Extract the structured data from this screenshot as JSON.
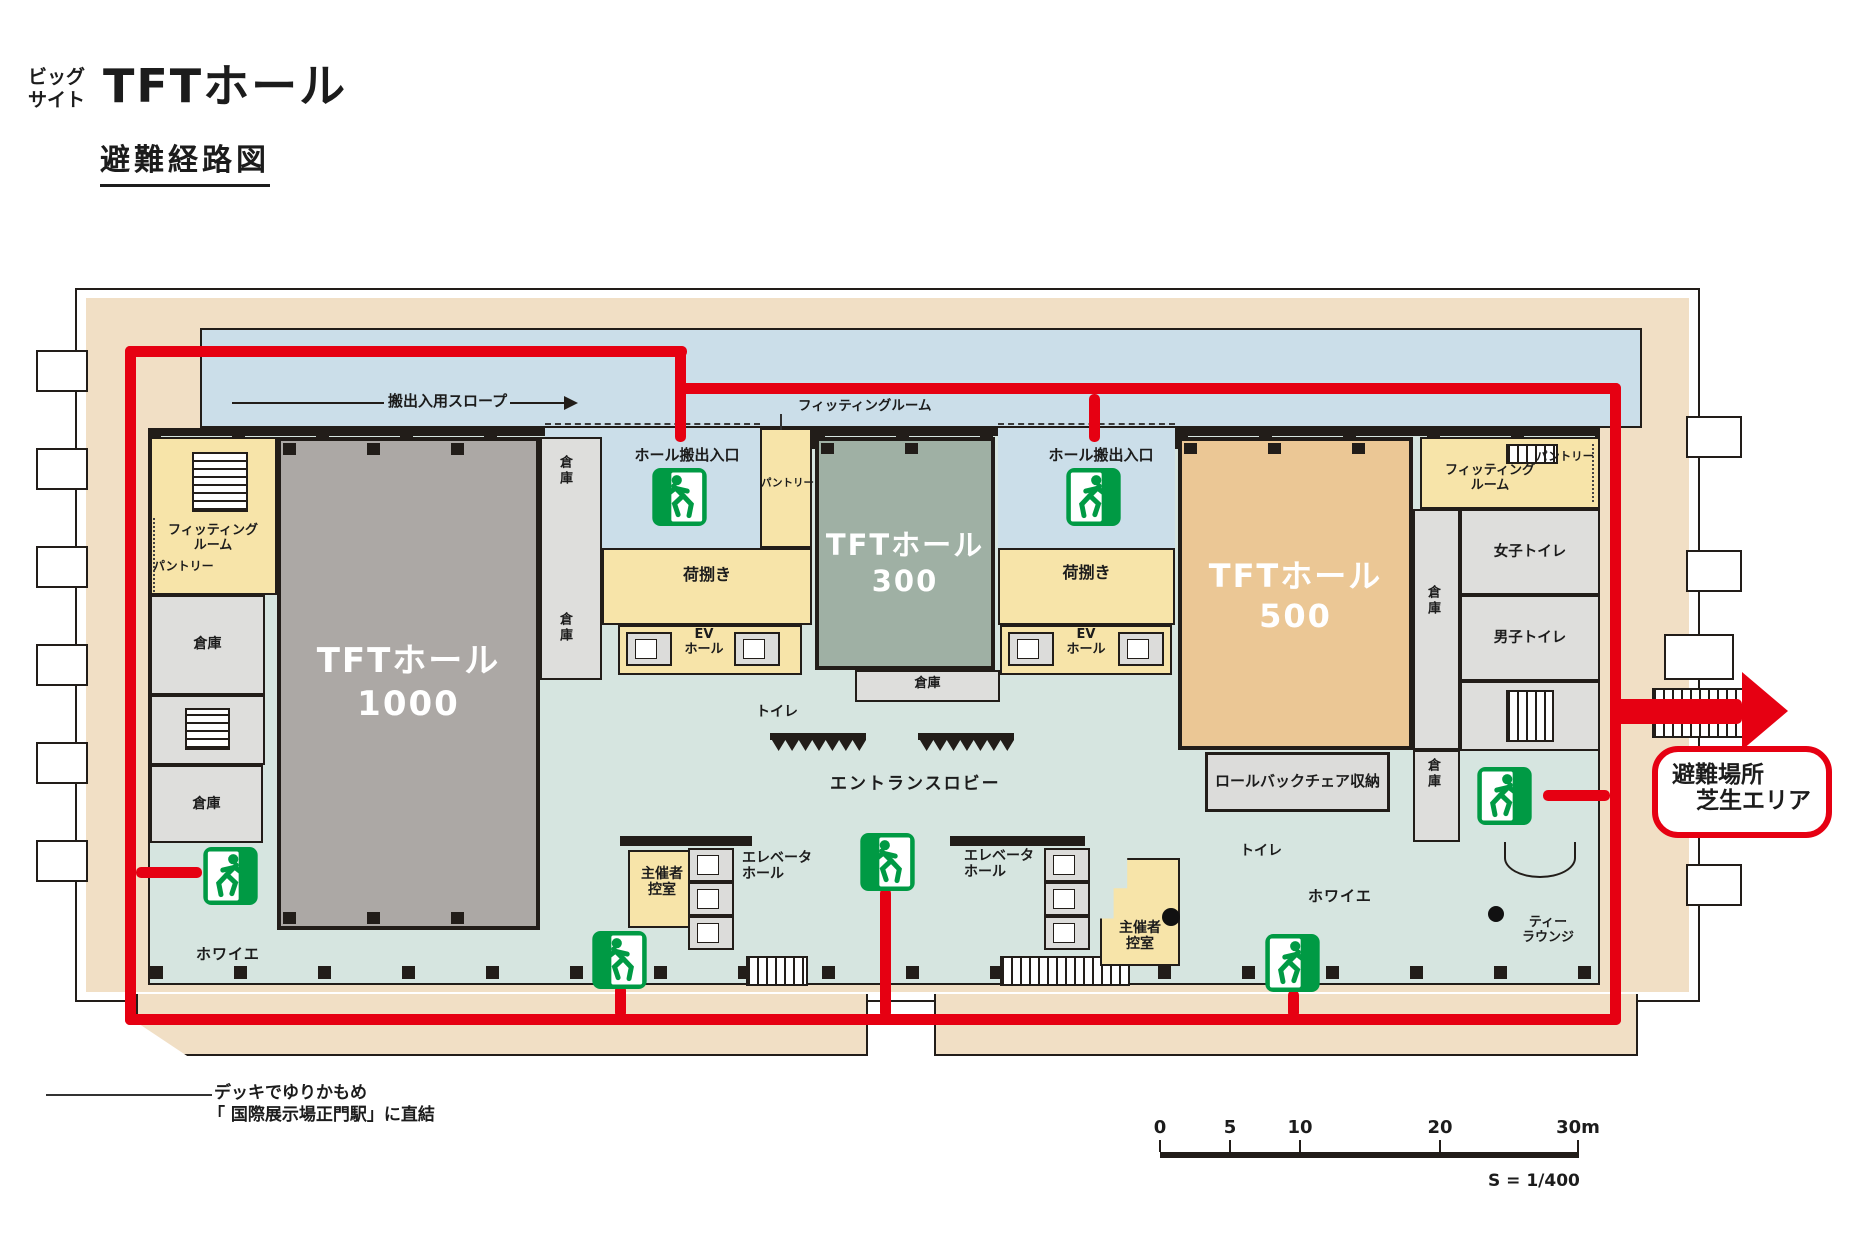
{
  "header": {
    "site_small": [
      "ビッグ",
      "サイト"
    ],
    "title": "TFTホール",
    "subtitle": "避難経路図"
  },
  "plan": {
    "slope_label": "搬出入用スロープ",
    "hall_exit_label": "ホール搬出入口",
    "halls": {
      "h1000": {
        "name": "TFTホール",
        "number": "1000"
      },
      "h300": {
        "name": "TFTホール",
        "number": "300"
      },
      "h500": {
        "name": "TFTホール",
        "number": "500"
      }
    },
    "rooms": {
      "fitting": [
        "フィッティング",
        "ルーム"
      ],
      "fitting_joined": "フィッティングルーム",
      "pantry": "パントリー",
      "storage": "倉庫",
      "cargo": "荷捌き",
      "ev_hall": [
        "EV",
        "ホール"
      ],
      "toilet": "トイレ",
      "entrance_lobby": "エントランスロビー",
      "organizer": [
        "主催者",
        "控室"
      ],
      "elevator_hall": [
        "エレベータ",
        "ホール"
      ],
      "foyer": "ホワイエ",
      "rollback_storage": "ロールバックチェア収納",
      "womens_toilet": "女子トイレ",
      "mens_toilet": "男子トイレ",
      "tea_lounge": [
        "ティー",
        "ラウンジ"
      ]
    },
    "evacuation_site": [
      "避難場所",
      "芝生エリア"
    ],
    "deck_note": [
      "デッキでゆりかもめ",
      "「 国際展示場正門駅」に直結"
    ],
    "scale": {
      "ticks": [
        "0",
        "5",
        "10",
        "20"
      ],
      "end": "30m",
      "ratio": "S = 1/400"
    }
  },
  "colors": {
    "route_red": "#E60012",
    "exit_green": "#009A44",
    "hall_gray": "#ACA8A5",
    "hall_green": "#9FB0A4",
    "hall_tan": "#EBC795",
    "service_yellow": "#F7E4A9",
    "slope_blue": "#CBDEE9",
    "floor_teal": "#D6E5E0",
    "band_beige": "#F1DFC5",
    "room_gray": "#DEDEDC",
    "wall_black": "#221D19"
  }
}
